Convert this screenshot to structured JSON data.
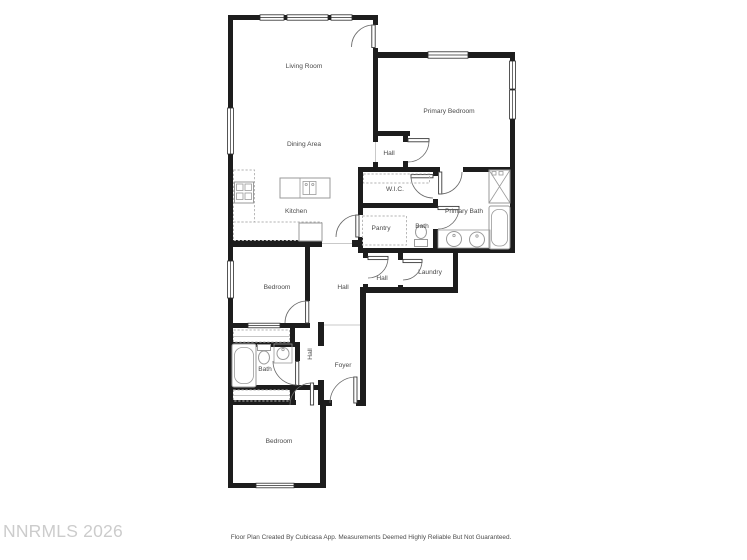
{
  "watermark": {
    "text": "NNRMLS 2026",
    "color": "#cccccc"
  },
  "caption": {
    "text": "Floor Plan Created By Cubicasa App. Measurements Deemed Highly Reliable But Not Guaranteed."
  },
  "floor_plan": {
    "wall_color": "#1d1d1d",
    "fixture_color": "#9a9a9a",
    "label_color": "#4a4a4a",
    "rooms": [
      {
        "id": "living-room",
        "label": "Living Room"
      },
      {
        "id": "dining-area",
        "label": "Dining Area"
      },
      {
        "id": "kitchen",
        "label": "Kitchen"
      },
      {
        "id": "hall-upper",
        "label": "Hall"
      },
      {
        "id": "primary-bedroom",
        "label": "Primary Bedroom"
      },
      {
        "id": "wic",
        "label": "W.I.C."
      },
      {
        "id": "pantry",
        "label": "Pantry"
      },
      {
        "id": "bath-water-closet",
        "label": "Bath"
      },
      {
        "id": "primary-bath",
        "label": "Primary Bath"
      },
      {
        "id": "bedroom-middle",
        "label": "Bedroom"
      },
      {
        "id": "hall-middle",
        "label": "Hall"
      },
      {
        "id": "hall-small",
        "label": "Hall"
      },
      {
        "id": "laundry",
        "label": "Laundry"
      },
      {
        "id": "bath-hall",
        "label": "Bath"
      },
      {
        "id": "hall-lower",
        "label": "Hall"
      },
      {
        "id": "foyer",
        "label": "Foyer"
      },
      {
        "id": "bedroom-lower",
        "label": "Bedroom"
      }
    ]
  }
}
